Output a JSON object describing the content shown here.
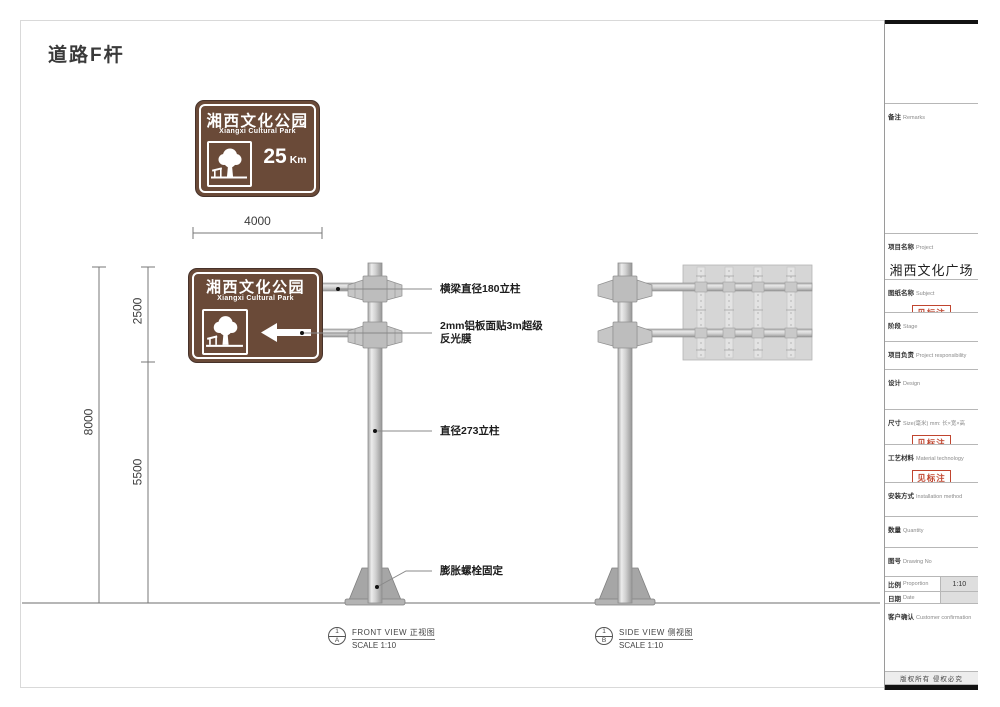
{
  "page_title": "道路F杆",
  "colors": {
    "sign_brown": "#6a4a38",
    "stamp_red": "#c0452f",
    "pole_gray": "#c9c9c9",
    "line_gray": "#8a8a8a"
  },
  "sign": {
    "title_cn": "湘西文化公园",
    "title_en": "Xiangxi Cultural Park",
    "distance_value": "25",
    "distance_unit": "Km"
  },
  "dimensions": {
    "width": "4000",
    "upper": "2500",
    "total": "8000",
    "lower": "5500"
  },
  "annotations": {
    "beam": "横梁直径180立柱",
    "film_line1": "2mm铝板面贴3m超级",
    "film_line2": "反光膜",
    "pole": "直径273立柱",
    "base": "膨胀螺栓固定"
  },
  "views": {
    "front": {
      "num": "1",
      "letter": "A",
      "label": "FRONT VIEW 正视图",
      "scale": "SCALE 1:10"
    },
    "side": {
      "num": "1",
      "letter": "B",
      "label": "SIDE VIEW 侧视图",
      "scale": "SCALE 1:10"
    }
  },
  "titleblock": {
    "remarks": {
      "cn": "备注",
      "en": "Remarks"
    },
    "project": {
      "cn": "项目名称",
      "en": "Project",
      "value": "湘西文化广场"
    },
    "subject": {
      "cn": "图纸名称",
      "en": "Subject",
      "stamp": "见标注"
    },
    "stage": {
      "cn": "阶段",
      "en": "Stage"
    },
    "responsibility": {
      "cn": "项目负责",
      "en": "Project responsibility"
    },
    "design": {
      "cn": "设计",
      "en": "Design"
    },
    "size": {
      "cn": "尺寸",
      "en": "Size(毫米) mm: 长×宽×高",
      "stamp": "见标注"
    },
    "material": {
      "cn": "工艺材料",
      "en": "Material technology",
      "stamp": "见标注"
    },
    "installation": {
      "cn": "安装方式",
      "en": "Installation method"
    },
    "quantity": {
      "cn": "数量",
      "en": "Quantity"
    },
    "drawing_no": {
      "cn": "图号",
      "en": "Drawing No"
    },
    "proportion": {
      "cn": "比例",
      "en": "Proportion",
      "value": "1:10"
    },
    "date": {
      "cn": "日期",
      "en": "Date"
    },
    "confirmation": {
      "cn": "客户确认",
      "en": "Customer confirmation"
    },
    "copyright": "版权所有 侵权必究"
  }
}
